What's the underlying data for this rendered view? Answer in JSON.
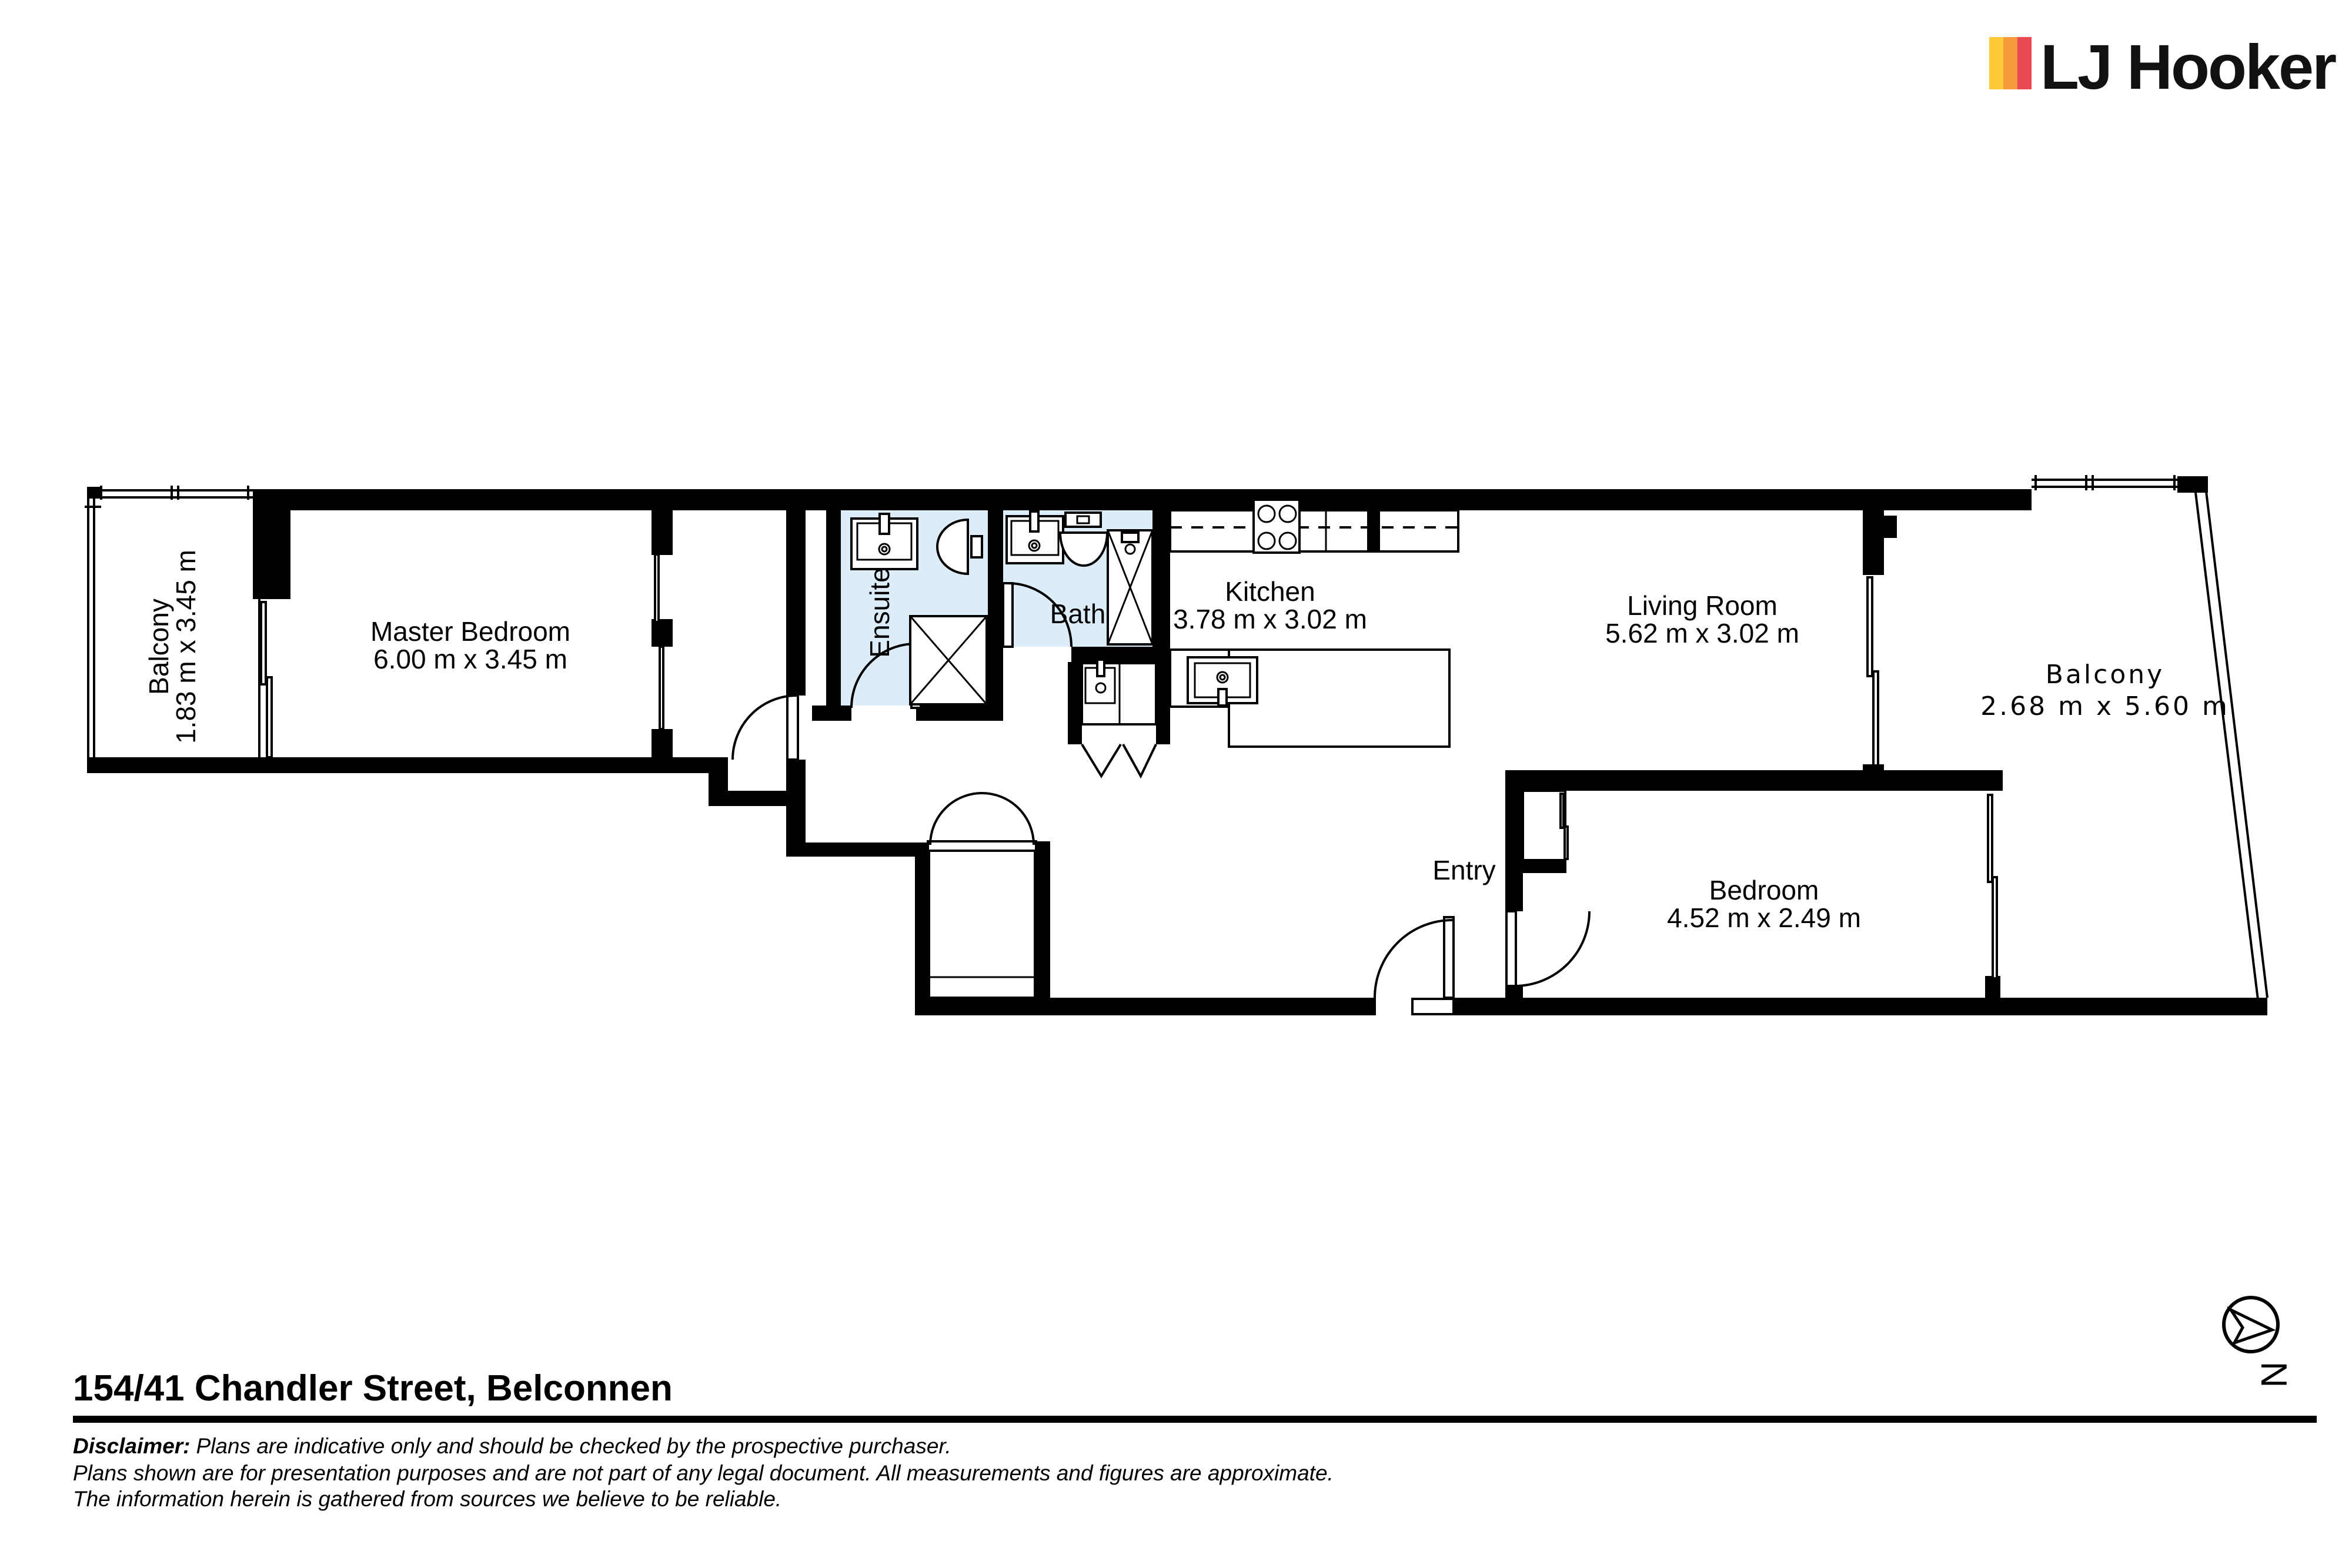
{
  "logo": {
    "brand": "LJ Hooker",
    "stripe_colors": [
      "#FFC937",
      "#F59A3D",
      "#E84850"
    ]
  },
  "plan": {
    "wet_area_fill": "#dcecf9",
    "rooms": {
      "balcony_left": {
        "name": "Balcony",
        "dims": "1.83 m x 3.45 m"
      },
      "master_bedroom": {
        "name": "Master Bedroom",
        "dims": "6.00 m x 3.45 m"
      },
      "ensuite": {
        "name": "Ensuite"
      },
      "bath": {
        "name": "Bath"
      },
      "kitchen": {
        "name": "Kitchen",
        "dims": "3.78 m x 3.02 m"
      },
      "living_room": {
        "name": "Living Room",
        "dims": "5.62 m x 3.02 m"
      },
      "balcony_right": {
        "name": "Balcony",
        "dims": "2.68 m x 5.60 m"
      },
      "bedroom": {
        "name": "Bedroom",
        "dims": "4.52 m x 2.49 m"
      },
      "entry": {
        "name": "Entry"
      }
    }
  },
  "footer": {
    "address": "154/41 Chandler Street, Belconnen",
    "disclaimer_label": "Disclaimer:",
    "disclaimer_line1": "Plans are indicative only and should be checked by the prospective purchaser.",
    "disclaimer_line2": "Plans shown are for presentation purposes and are not part of any legal document. All measurements and figures are approximate.",
    "disclaimer_line3": "The information herein is gathered from sources we believe to be reliable."
  },
  "compass": {
    "label": "N"
  }
}
